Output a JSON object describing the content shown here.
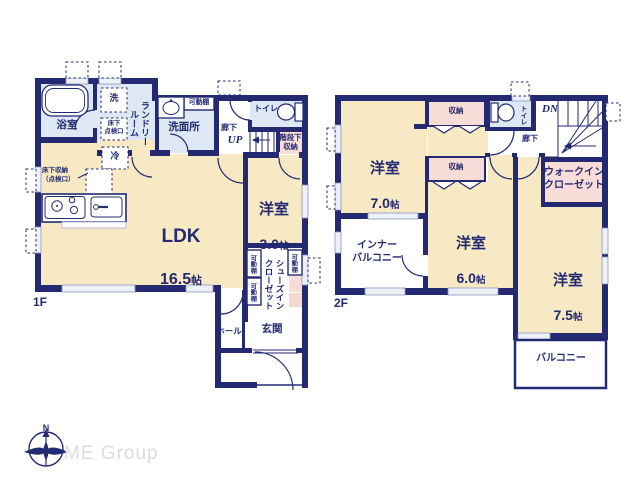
{
  "colors": {
    "wall": "#232a72",
    "room_cream": "#f8e9c5",
    "room_blue": "#dde8f4",
    "room_pink": "#f8dcd7",
    "window_fill": "#eef0f7",
    "logo_gray": "#dcdcdc"
  },
  "f1": {
    "floor_label": "1F",
    "bath": "浴室",
    "washer": "洗",
    "laundry_room": "ランドリー\nルーム",
    "underfloor_hatch": "床下\n点検口",
    "movable_shelf": "可動棚",
    "washroom": "洗面所",
    "corridor": "廊下",
    "up": "UP",
    "toilet": "トイレ",
    "under_stairs": "階段下\n収納",
    "fridge": "冷",
    "floor_storage": "床下収納\n（点検口）",
    "ldk": {
      "name": "LDK",
      "num": "16.5",
      "unit": "帖"
    },
    "western3": {
      "name": "洋室",
      "num": "3.0",
      "unit": "帖"
    },
    "sic": "シューズイン\nクローゼット",
    "genkan": "玄関",
    "hall": "ホール"
  },
  "f2": {
    "floor_label": "2F",
    "western7": {
      "name": "洋室",
      "num": "7.0",
      "unit": "帖"
    },
    "western6": {
      "name": "洋室",
      "num": "6.0",
      "unit": "帖"
    },
    "western75": {
      "name": "洋室",
      "num": "7.5",
      "unit": "帖"
    },
    "storage": "収納",
    "toilet": "トイレ",
    "dn": "DN",
    "corridor": "廊下",
    "wic": "ウォークイン\nクローゼット",
    "inner_balcony": "インナー\nバルコニー",
    "balcony": "バルコニー"
  },
  "footer": {
    "brand": "ME Group",
    "compass_north": "N"
  }
}
